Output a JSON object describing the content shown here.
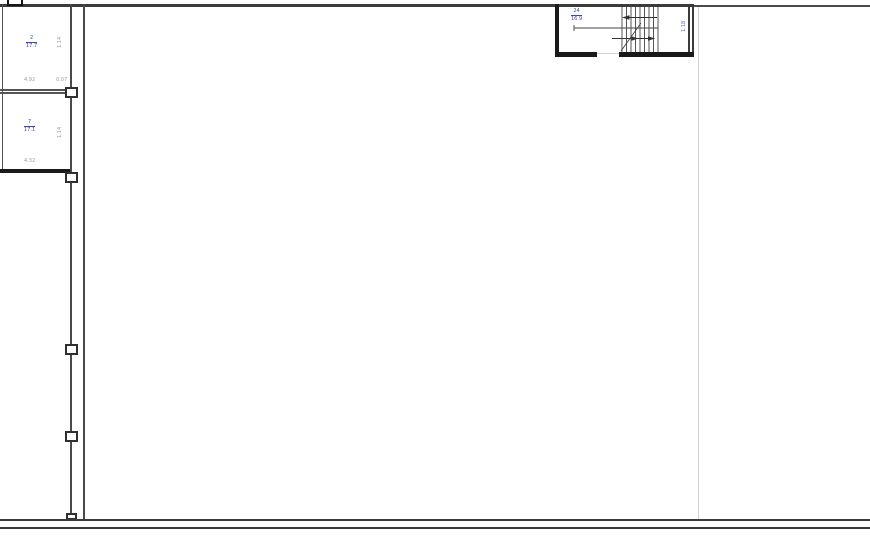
{
  "meta": {
    "drawing_type": "architectural-floor-plan",
    "view": "ground-floor-hall"
  },
  "colors": {
    "wall": "#3b3b3b",
    "wall_dark": "#1a1a1a",
    "faint_line": "#d2d2d2",
    "tag_blue": "#3f46b5",
    "dim_gray": "#9b9b9b",
    "background": "#ffffff"
  },
  "tags": {
    "room_a": {
      "num": "2",
      "den": "17.7"
    },
    "room_b": {
      "num": "7",
      "den": "17.1"
    },
    "stair": {
      "num": "24",
      "den": "16.9"
    }
  },
  "dims": {
    "room_a_width": "4.92",
    "wall_offset": "0.07",
    "room_a_height": "1.14",
    "room_b_height": "1.14",
    "room_b_width": "4.32",
    "stair_width": "1.18"
  }
}
